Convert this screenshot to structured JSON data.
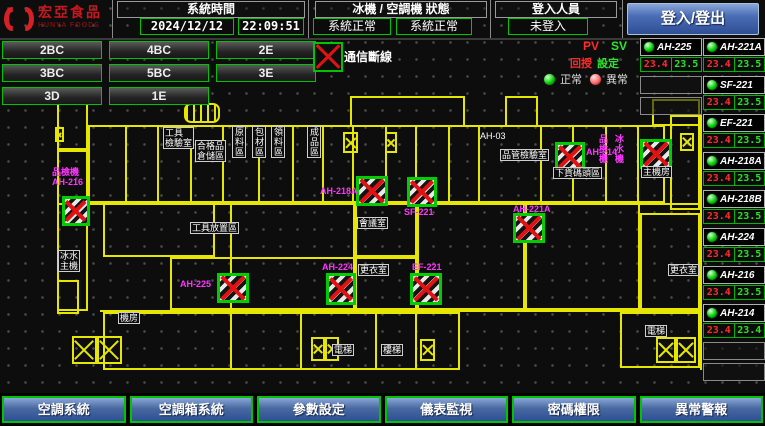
{
  "header": {
    "logo": {
      "name": "宏亞食品",
      "sub": "HUNYA FOODS"
    },
    "system_time": {
      "label": "系統時間",
      "date": "2024/12/12",
      "time": "22:09:51"
    },
    "machine_status": {
      "label": "冰機 / 空調機 狀態",
      "chiller_status": "系統正常",
      "ahu_status": "系統正常"
    },
    "login": {
      "label": "登入人員",
      "value": "未登入",
      "button_label": "登入/登出"
    }
  },
  "floor_buttons": [
    [
      "2BC",
      "4BC",
      "2E"
    ],
    [
      "3BC",
      "5BC",
      "3E"
    ],
    [
      "3D",
      "1E"
    ]
  ],
  "legend": {
    "comm_fail": "通信斷線",
    "normal": "正常",
    "abnormal": "異常"
  },
  "readout": {
    "pv": "PV",
    "sv": "SV",
    "pv_name": "回授",
    "sv_name": "設定"
  },
  "units": [
    {
      "name": "AH-225",
      "pv": "23.4",
      "sv": "23.5"
    },
    {
      "name": "AH-221A",
      "pv": "23.4",
      "sv": "23.5"
    },
    {
      "name": "SF-221",
      "pv": "23.4",
      "sv": "23.5"
    },
    {
      "name": "EF-221",
      "pv": "23.4",
      "sv": "23.5"
    },
    {
      "name": "AH-218A",
      "pv": "23.4",
      "sv": "23.5"
    },
    {
      "name": "AH-218B",
      "pv": "23.4",
      "sv": "23.5"
    },
    {
      "name": "AH-224",
      "pv": "23.4",
      "sv": "23.5"
    },
    {
      "name": "AH-216",
      "pv": "23.4",
      "sv": "23.5"
    },
    {
      "name": "AH-214",
      "pv": "23.4",
      "sv": "23.4"
    }
  ],
  "bottom_buttons": [
    "空調系統",
    "空調箱系統",
    "參數設定",
    "儀表監視",
    "密碼權限",
    "異常警報"
  ],
  "colors": {
    "accent_green": "#00c400",
    "plan_yellow": "#e6e600",
    "label_magenta": "#ff35ff",
    "alarm_red": "#e31212",
    "button_blue": "#4a6db5",
    "led_green": "#00d000",
    "led_red": "#ff6a6a",
    "logo_red": "#d81f26"
  },
  "floor_plan": {
    "rooms": [
      [
        88,
        125,
        577,
        78
      ],
      [
        350,
        96,
        115,
        31
      ],
      [
        505,
        96,
        33,
        31
      ],
      [
        652,
        99,
        48,
        27
      ],
      [
        57,
        150,
        31,
        161
      ],
      [
        57,
        103,
        31,
        47
      ],
      [
        103,
        203,
        112,
        54
      ],
      [
        170,
        257,
        185,
        53
      ],
      [
        230,
        203,
        125,
        107
      ],
      [
        355,
        203,
        62,
        54
      ],
      [
        355,
        257,
        62,
        53
      ],
      [
        417,
        203,
        108,
        107
      ],
      [
        525,
        203,
        115,
        107
      ],
      [
        640,
        213,
        60,
        97
      ],
      [
        103,
        312,
        357,
        58
      ],
      [
        620,
        312,
        80,
        56
      ],
      [
        57,
        280,
        22,
        34
      ],
      [
        670,
        115,
        30,
        95
      ]
    ],
    "partitions": [
      [
        125,
        125,
        2,
        78
      ],
      [
        157,
        125,
        2,
        78
      ],
      [
        190,
        125,
        2,
        78
      ],
      [
        222,
        125,
        2,
        78
      ],
      [
        258,
        125,
        2,
        78
      ],
      [
        292,
        125,
        2,
        78
      ],
      [
        322,
        125,
        2,
        78
      ],
      [
        352,
        125,
        2,
        78
      ],
      [
        385,
        125,
        2,
        78
      ],
      [
        415,
        125,
        2,
        78
      ],
      [
        448,
        125,
        2,
        78
      ],
      [
        478,
        125,
        2,
        78
      ],
      [
        540,
        125,
        2,
        78
      ],
      [
        572,
        125,
        2,
        78
      ],
      [
        605,
        125,
        2,
        78
      ],
      [
        637,
        125,
        2,
        78
      ],
      [
        57,
        203,
        645,
        2
      ],
      [
        100,
        310,
        600,
        2
      ],
      [
        230,
        312,
        2,
        58
      ],
      [
        300,
        312,
        2,
        58
      ],
      [
        375,
        312,
        2,
        58
      ],
      [
        415,
        312,
        2,
        58
      ],
      [
        700,
        115,
        2,
        255
      ]
    ],
    "markers": [
      [
        62,
        196,
        28,
        30
      ],
      [
        217,
        273,
        32,
        30
      ],
      [
        356,
        176,
        32,
        30
      ],
      [
        407,
        177,
        30,
        30
      ],
      [
        410,
        273,
        32,
        32
      ],
      [
        326,
        273,
        30,
        32
      ],
      [
        555,
        142,
        30,
        30
      ],
      [
        640,
        139,
        32,
        30
      ],
      [
        513,
        213,
        32,
        30
      ]
    ],
    "xboxes": [
      [
        72,
        336,
        25,
        28
      ],
      [
        97,
        336,
        25,
        28
      ],
      [
        311,
        337,
        14,
        24
      ],
      [
        325,
        337,
        14,
        24
      ],
      [
        420,
        339,
        15,
        22
      ],
      [
        656,
        337,
        20,
        26
      ],
      [
        676,
        337,
        20,
        26
      ],
      [
        343,
        132,
        15,
        21
      ],
      [
        385,
        132,
        12,
        21
      ],
      [
        55,
        127,
        9,
        15
      ],
      [
        680,
        133,
        14,
        18
      ]
    ],
    "grill": [
      184,
      103,
      36,
      20
    ],
    "labels": [
      {
        "x": 52,
        "y": 167,
        "t": "品檢機\nAH-216",
        "c": "m"
      },
      {
        "x": 180,
        "y": 279,
        "t": "AH-225",
        "c": "m"
      },
      {
        "x": 320,
        "y": 186,
        "t": "AH-218A",
        "c": "m"
      },
      {
        "x": 404,
        "y": 207,
        "t": "SF-221",
        "c": "m"
      },
      {
        "x": 412,
        "y": 262,
        "t": "EF-221",
        "c": "m"
      },
      {
        "x": 322,
        "y": 262,
        "t": "AH-224",
        "c": "m"
      },
      {
        "x": 586,
        "y": 147,
        "t": "AH-214",
        "c": "m"
      },
      {
        "x": 598,
        "y": 134,
        "t": "品檢機",
        "c": "m",
        "v": true
      },
      {
        "x": 614,
        "y": 134,
        "t": "冰水機",
        "c": "m",
        "v": true
      },
      {
        "x": 513,
        "y": 204,
        "t": "AH-221A",
        "c": "m"
      },
      {
        "x": 163,
        "y": 127,
        "t": "工具\n檢驗室",
        "c": "w",
        "b": true
      },
      {
        "x": 195,
        "y": 140,
        "t": "合格品\n倉儲區",
        "c": "w",
        "b": true
      },
      {
        "x": 232,
        "y": 126,
        "t": "原料區",
        "c": "w",
        "v": true,
        "b": true
      },
      {
        "x": 252,
        "y": 126,
        "t": "包材區",
        "c": "w",
        "v": true,
        "b": true
      },
      {
        "x": 271,
        "y": 126,
        "t": "領料區",
        "c": "w",
        "v": true,
        "b": true
      },
      {
        "x": 307,
        "y": 126,
        "t": "成品區",
        "c": "w",
        "v": true,
        "b": true
      },
      {
        "x": 190,
        "y": 222,
        "t": "工具放置區",
        "c": "w",
        "b": true
      },
      {
        "x": 357,
        "y": 217,
        "t": "會議室",
        "c": "w",
        "b": true
      },
      {
        "x": 358,
        "y": 264,
        "t": "更衣室",
        "c": "w",
        "b": true
      },
      {
        "x": 668,
        "y": 264,
        "t": "更衣室",
        "c": "w",
        "b": true
      },
      {
        "x": 58,
        "y": 250,
        "t": "冰水\n主機",
        "c": "w",
        "b": true
      },
      {
        "x": 118,
        "y": 312,
        "t": "機房",
        "c": "w",
        "b": true
      },
      {
        "x": 332,
        "y": 344,
        "t": "電梯",
        "c": "w",
        "b": true
      },
      {
        "x": 381,
        "y": 344,
        "t": "樓梯",
        "c": "w",
        "b": true
      },
      {
        "x": 645,
        "y": 325,
        "t": "電梯",
        "c": "w",
        "b": true
      },
      {
        "x": 500,
        "y": 149,
        "t": "品管檢驗室",
        "c": "w",
        "b": true
      },
      {
        "x": 553,
        "y": 167,
        "t": "下貨碼頭區",
        "c": "w",
        "b": true
      },
      {
        "x": 641,
        "y": 166,
        "t": "主機房",
        "c": "w",
        "b": true
      },
      {
        "x": 480,
        "y": 131,
        "t": "AH-03",
        "c": "w"
      }
    ]
  }
}
